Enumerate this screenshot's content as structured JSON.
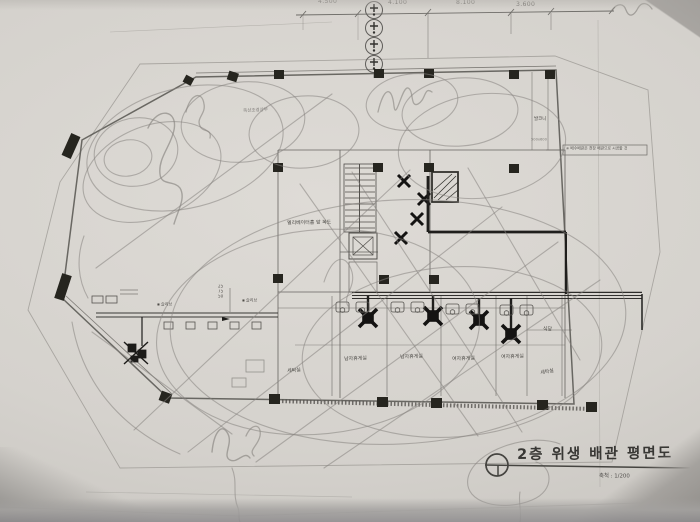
{
  "title_block": {
    "title": "2층 위생 배관 평면도",
    "scale_label": "축척 : 1/200"
  },
  "dimensions": {
    "labels": [
      "4.500",
      "4.100",
      "8.100",
      "3.600"
    ]
  },
  "rooms": {
    "corridor": "엘리베이터홀 앞 복도",
    "laundry_left": "세탁실",
    "mens_lounge_1": "남자휴게실",
    "mens_lounge_2": "남자휴게실",
    "womens_lounge_1": "여자휴게실",
    "womens_lounge_2": "여자휴게실",
    "laundry_right": "세탁실",
    "dining": "식당",
    "balcony": "발코니",
    "roof_garden_note": "옥상조경상부"
  },
  "annotations": {
    "pipe_sizes": [
      "25",
      "75",
      "50"
    ],
    "sleeve_label_1": "슬리브",
    "sleeve_label_2": "슬리브",
    "size_note": "500x600",
    "boxed_note": "※ 배수배관은 천장 배관으로 시공할 것"
  },
  "icons": {
    "sleeve_symbol": "▪"
  },
  "colors": {
    "paper": "#d7d4cf",
    "pencil": "#87847f",
    "ink": "#3f3e3b",
    "black_fill": "#26251f"
  }
}
